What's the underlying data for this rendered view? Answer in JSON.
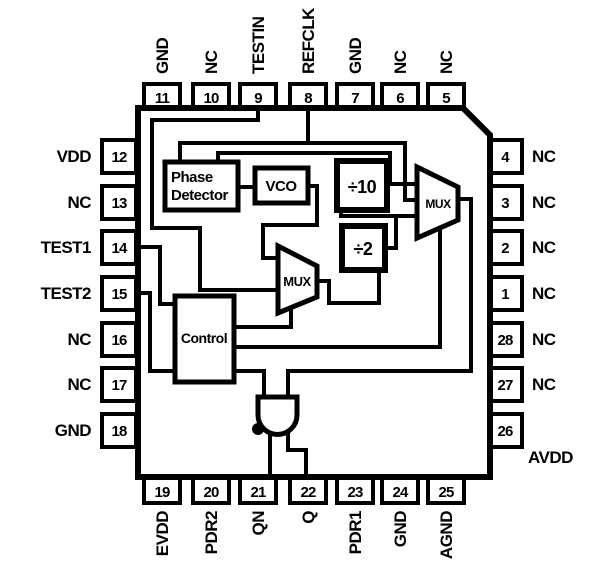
{
  "pins": {
    "top": [
      {
        "num": "11",
        "label": "GND"
      },
      {
        "num": "10",
        "label": "NC"
      },
      {
        "num": "9",
        "label": "TESTIN"
      },
      {
        "num": "8",
        "label": "REFCLK"
      },
      {
        "num": "7",
        "label": "GND"
      },
      {
        "num": "6",
        "label": "NC"
      },
      {
        "num": "5",
        "label": "NC"
      }
    ],
    "left": [
      {
        "num": "12",
        "label": "VDD"
      },
      {
        "num": "13",
        "label": "NC"
      },
      {
        "num": "14",
        "label": "TEST1"
      },
      {
        "num": "15",
        "label": "TEST2"
      },
      {
        "num": "16",
        "label": "NC"
      },
      {
        "num": "17",
        "label": "NC"
      },
      {
        "num": "18",
        "label": "GND"
      }
    ],
    "right": [
      {
        "num": "4",
        "label": "NC"
      },
      {
        "num": "3",
        "label": "NC"
      },
      {
        "num": "2",
        "label": "NC"
      },
      {
        "num": "1",
        "label": "NC"
      },
      {
        "num": "28",
        "label": "NC"
      },
      {
        "num": "27",
        "label": "NC"
      },
      {
        "num": "26",
        "label": "AVDD"
      }
    ],
    "bottom": [
      {
        "num": "19",
        "label": "EVDD"
      },
      {
        "num": "20",
        "label": "PDR2"
      },
      {
        "num": "21",
        "label": "QN"
      },
      {
        "num": "22",
        "label": "Q"
      },
      {
        "num": "23",
        "label": "PDR1"
      },
      {
        "num": "24",
        "label": "GND"
      },
      {
        "num": "25",
        "label": "AGND"
      }
    ]
  },
  "blocks": {
    "phase_detector_line1": "Phase",
    "phase_detector_line2": "Detector",
    "vco": "VCO",
    "div10": "÷10",
    "div2": "÷2",
    "mux_right": "MUX",
    "mux_mid": "MUX",
    "control": "Control"
  },
  "colors": {
    "ink": "#000000",
    "bg": "#ffffff"
  }
}
